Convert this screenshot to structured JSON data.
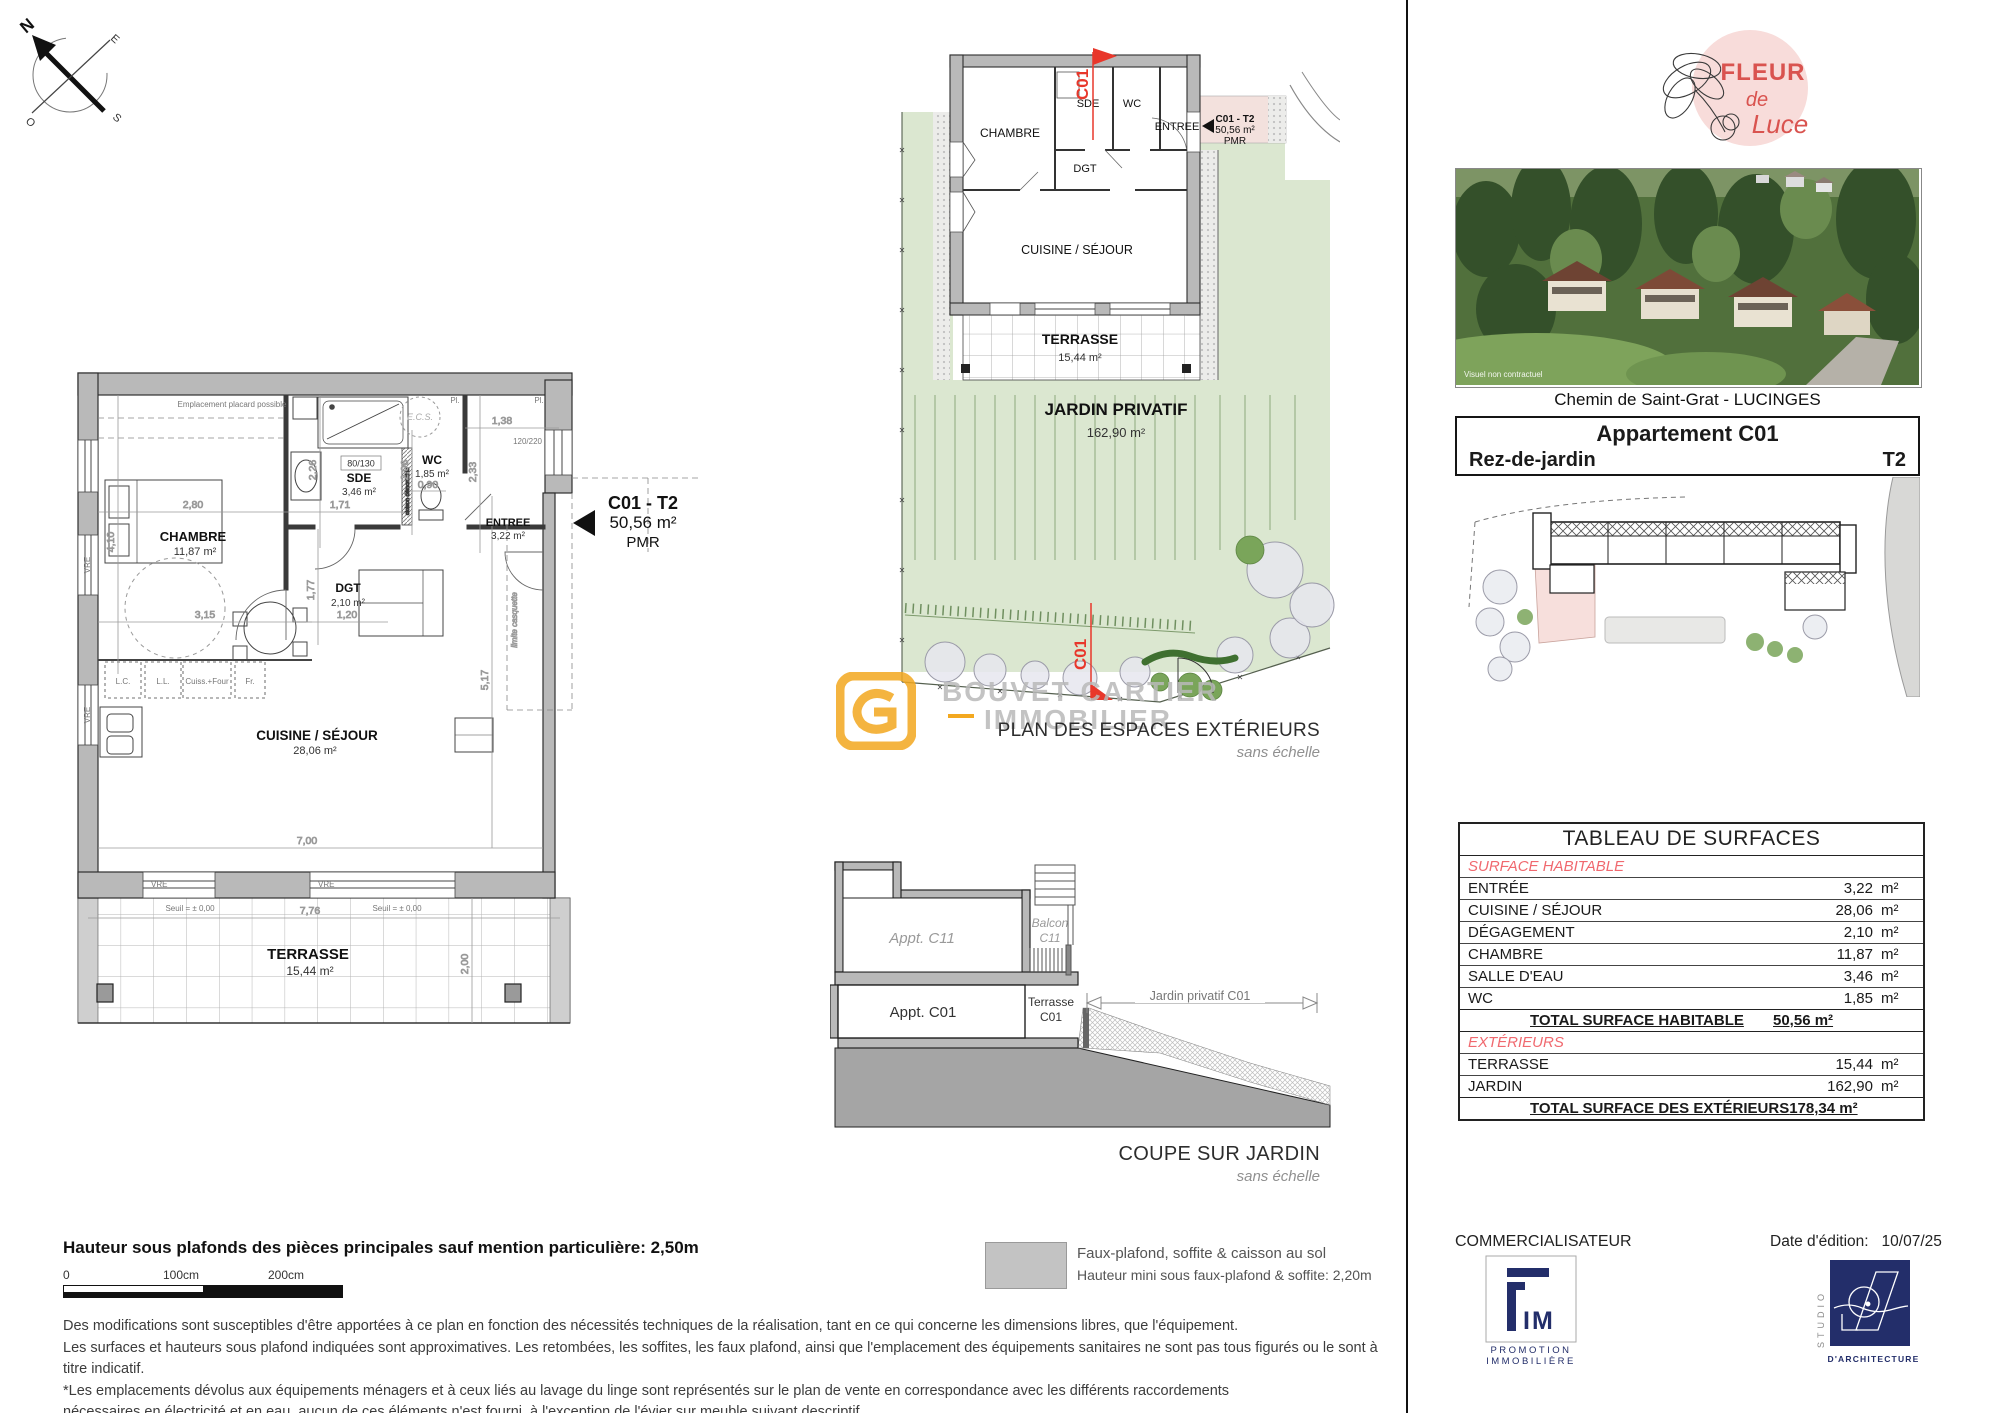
{
  "compass": {
    "n": "N",
    "e": "E",
    "s": "S",
    "o": "O"
  },
  "unit_label": {
    "code": "C01 - T2",
    "area": "50,56 m²",
    "pmr": "PMR"
  },
  "main_plan": {
    "placard_note": "Emplacement placard possible",
    "rooms": {
      "chambre": {
        "name": "CHAMBRE",
        "area": "11,87 m²"
      },
      "sde": {
        "name": "SDE",
        "area": "3,46 m²",
        "size": "80/130"
      },
      "wc": {
        "name": "WC",
        "area": "1,85 m²"
      },
      "entree": {
        "name": "ENTREE",
        "area": "3,22 m²"
      },
      "dgt": {
        "name": "DGT",
        "area": "2,10 m²"
      },
      "cuisine": {
        "name": "CUISINE / SÉJOUR",
        "area": "28,06 m²"
      },
      "terrasse": {
        "name": "TERRASSE",
        "area": "15,44 m²"
      }
    },
    "dims": {
      "d280": "2,80",
      "d410": "4,10",
      "d315": "3,15",
      "d171": "1,71",
      "d090": "0,90",
      "d138": "1,38",
      "d233": "2,33",
      "d226": "2,26",
      "d206": "2,06",
      "d177": "1,77",
      "d120": "1,20",
      "d700": "7,00",
      "d517": "5,17",
      "d776": "7,76",
      "d200": "2,00"
    },
    "labels": {
      "ecs": "E.C.S.",
      "pl": "Pl.",
      "window": "120/220",
      "lc": "L.C.",
      "ll": "L.L.",
      "cuiss": "Cuiss.+Four",
      "fr": "Fr.",
      "vre": "VRE",
      "seuil": "Seuil = ± 0,00",
      "limite": "limite casquette",
      "cloison": "cloison démontable"
    }
  },
  "ext_plan": {
    "rooms": {
      "chambre": "CHAMBRE",
      "sde": "SDE",
      "wc": "WC",
      "entree": "ENTREE",
      "dgt": "DGT",
      "cuisine": "CUISINE / SÉJOUR"
    },
    "terrasse": {
      "name": "TERRASSE",
      "area": "15,44 m²"
    },
    "jardin": {
      "name": "JARDIN PRIVATIF",
      "area": "162,90 m²"
    },
    "marker": "C01",
    "caption": "PLAN DES ESPACES EXTÉRIEURS",
    "caption_sub": "sans échelle"
  },
  "watermark": {
    "line1": "BOUVET CARTIER",
    "line2": "IMMOBILIER"
  },
  "coupe": {
    "appt_c11": "Appt. C11",
    "balcon1": "Balcon",
    "balcon2": "C11",
    "appt_c01": "Appt. C01",
    "terrasse1": "Terrasse",
    "terrasse2": "C01",
    "jardin": "Jardin privatif C01",
    "caption": "COUPE SUR JARDIN",
    "caption_sub": "sans échelle"
  },
  "brand": {
    "fleur": "FLEUR",
    "de": "de",
    "luce": "Luce"
  },
  "photo": {
    "note": "Visuel non contractuel"
  },
  "address": "Chemin de Saint-Grat - LUCINGES",
  "info_box": {
    "title": "Appartement C01",
    "level": "Rez-de-jardin",
    "type": "T2"
  },
  "surface_table": {
    "title": "TABLEAU DE SURFACES",
    "section1": "SURFACE HABITABLE",
    "rows1": [
      {
        "label": "ENTRÉE",
        "value": "3,22",
        "unit": "m²"
      },
      {
        "label": "CUISINE / SÉJOUR",
        "value": "28,06",
        "unit": "m²"
      },
      {
        "label": "DÉGAGEMENT",
        "value": "2,10",
        "unit": "m²"
      },
      {
        "label": "CHAMBRE",
        "value": "11,87",
        "unit": "m²"
      },
      {
        "label": "SALLE D'EAU",
        "value": "3,46",
        "unit": "m²"
      },
      {
        "label": "WC",
        "value": "1,85",
        "unit": "m²"
      }
    ],
    "total1": {
      "label": "TOTAL SURFACE HABITABLE",
      "value": "50,56 m²"
    },
    "section2": "EXTÉRIEURS",
    "rows2": [
      {
        "label": "TERRASSE",
        "value": "15,44",
        "unit": "m²"
      },
      {
        "label": "JARDIN",
        "value": "162,90",
        "unit": "m²"
      }
    ],
    "total2": {
      "label": "TOTAL SURFACE DES EXTÉRIEURS",
      "value": "178,34 m²"
    }
  },
  "footer": {
    "commercialisateur": "COMMERCIALISATEUR",
    "fim": {
      "im": "IM",
      "line1": "PROMOTION",
      "line2": "IMMOBILIÈRE"
    },
    "date_label": "Date d'édition:",
    "date_value": "10/07/25",
    "studio": {
      "vertical": "STUDIO",
      "below": "D'ARCHITECTURE"
    }
  },
  "notes": {
    "height_note": "Hauteur sous plafonds des pièces principales sauf mention particulière: 2,50m",
    "scale": {
      "s0": "0",
      "s100": "100cm",
      "s200": "200cm"
    },
    "legend": {
      "line1": "Faux-plafond, soffite & caisson au sol",
      "line2": "Hauteur mini sous faux-plafond & soffite: 2,20m"
    },
    "disclaimer": [
      "Des modifications sont susceptibles d'être apportées à ce plan en fonction des nécessités techniques de la réalisation, tant en ce qui concerne les dimensions libres, que l'équipement.",
      "Les surfaces et hauteurs sous plafond indiquées sont approximatives. Les retombées, les soffites, les faux plafond, ainsi que l'emplacement des équipements sanitaires ne sont pas tous figurés ou le sont à titre indicatif.",
      "*Les emplacements dévolus aux équipements ménagers et à ceux liés au lavage du linge sont représentés sur le plan de vente en correspondance avec les différents raccordements",
      "nécessaires en électricité et en eau, aucun de ces éléments n'est fourni, à l'exception de l'évier sur meuble suivant descriptif."
    ]
  }
}
